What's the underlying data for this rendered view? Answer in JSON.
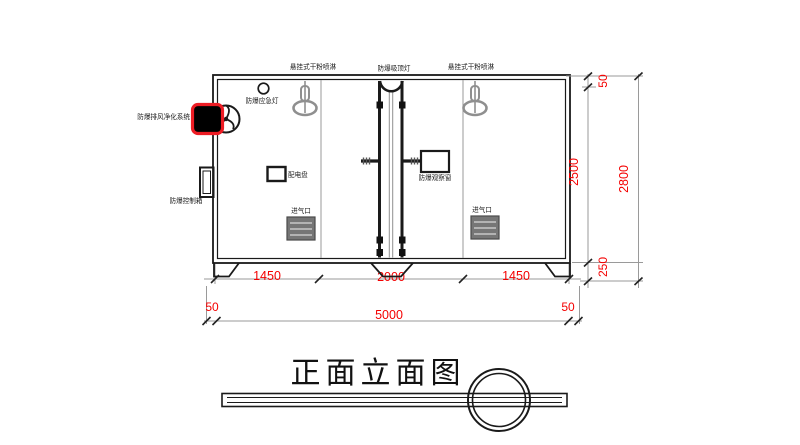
{
  "title": "正面立面图",
  "colors": {
    "dimension_red": "#f40000",
    "accent_red": "#ed1c24",
    "line_black": "#1a1a1a",
    "line_gray": "#9a9a9a",
    "component_gray": "#8f8f8f",
    "vent_gray": "#767676"
  },
  "labels": {
    "sprinkler_left": "悬挂式干粉喷淋",
    "ceiling_lamp": "防爆吸顶灯",
    "sprinkler_right": "悬挂式干粉喷淋",
    "emergency_light": "防爆应急灯",
    "purification_system": "防爆排风净化系统",
    "control_box": "防爆控制箱",
    "distribution_panel": "配电盘",
    "observation_window": "防爆观察窗",
    "air_inlet_left": "进气口",
    "air_inlet_right": "进气口"
  },
  "dimensions": {
    "bottom_segments": [
      "1450",
      "2000",
      "1450"
    ],
    "bottom_margin_left": "50",
    "bottom_total": "5000",
    "bottom_margin_right": "50",
    "right_top": "50",
    "right_middle": "2500",
    "right_bottom": "250",
    "right_total": "2800"
  }
}
